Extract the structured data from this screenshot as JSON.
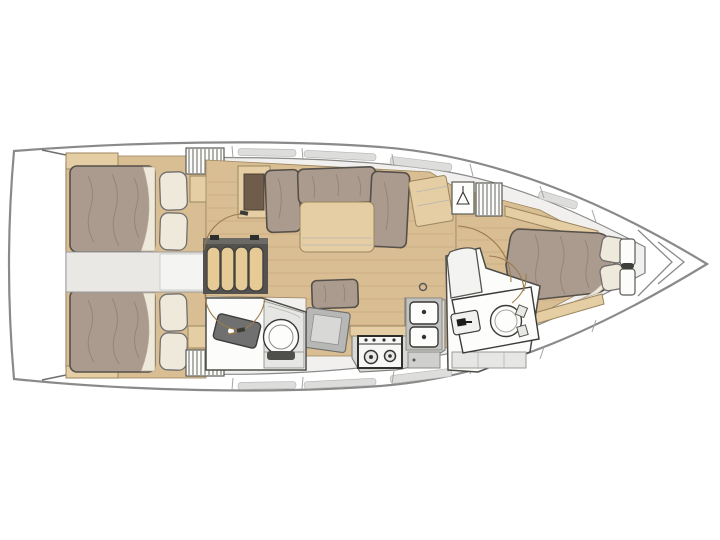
{
  "diagram": {
    "type": "sailboat-interior-floor-plan",
    "orientation": {
      "bow": "right",
      "stern": "left"
    },
    "rooms": [
      {
        "id": "transom-platform",
        "label": "transom platform"
      },
      {
        "id": "aft-cabin-port",
        "label": "aft double cabin (top)",
        "fixtures": [
          "double-berth",
          "two-pillows",
          "hanging-locker",
          "shelf"
        ]
      },
      {
        "id": "aft-cabin-starboard",
        "label": "aft double cabin (bottom)",
        "fixtures": [
          "double-berth",
          "two-pillows",
          "hanging-locker",
          "shelf"
        ]
      },
      {
        "id": "companionway",
        "label": "companionway steps",
        "fixtures": [
          "four-step-ladder",
          "handrails"
        ]
      },
      {
        "id": "saloon",
        "label": "saloon",
        "fixtures": [
          "l-shaped-settee",
          "saloon-table",
          "sideboard",
          "bench-seat",
          "folding-panel",
          "cabinet-with-dark-inset",
          "floor-fitting"
        ]
      },
      {
        "id": "aft-head",
        "label": "aft head with shower",
        "fixtures": [
          "washbasin",
          "toilet",
          "shower-stall"
        ]
      },
      {
        "id": "galley",
        "label": "galley",
        "fixtures": [
          "two-burner-stove",
          "double-sink",
          "fridge-front"
        ]
      },
      {
        "id": "forward-head",
        "label": "forward head / vanity",
        "fixtures": [
          "vanity-counter",
          "washbasin",
          "toilet-seat",
          "steps"
        ]
      },
      {
        "id": "forward-cabin",
        "label": "forward master cabin",
        "fixtures": [
          "island-double-berth",
          "two-pillows",
          "hanging-locker",
          "hatched-locker",
          "bedside-shelves",
          "bow-shelves"
        ]
      },
      {
        "id": "bow-locker",
        "label": "anchor locker"
      }
    ],
    "icons": [
      "hanger-icon"
    ],
    "palette": {
      "hull_line": "#8a8a8a",
      "interior_bg": "#f1f0ee",
      "room_white": "#fcfcfb",
      "wood_floor": "#d9bd93",
      "wood_plank_line": "#c2a277",
      "wood_furniture": "#e5cea4",
      "wood_edge": "#9c865f",
      "wood_dark_inset": "#6f5c4a",
      "cushion": "#ab9b8e",
      "cushion_streak": "#8f8173",
      "cushion_outline": "#55504a",
      "bedding_cream": "#efe9dc",
      "counter_gray": "#d8d8d6",
      "dark_gray": "#707070",
      "outline_dark": "#4c4c48",
      "door_arc": "#9b7b4a",
      "hatch_line": "#55554f",
      "step_wood": "#e7cb96"
    }
  }
}
